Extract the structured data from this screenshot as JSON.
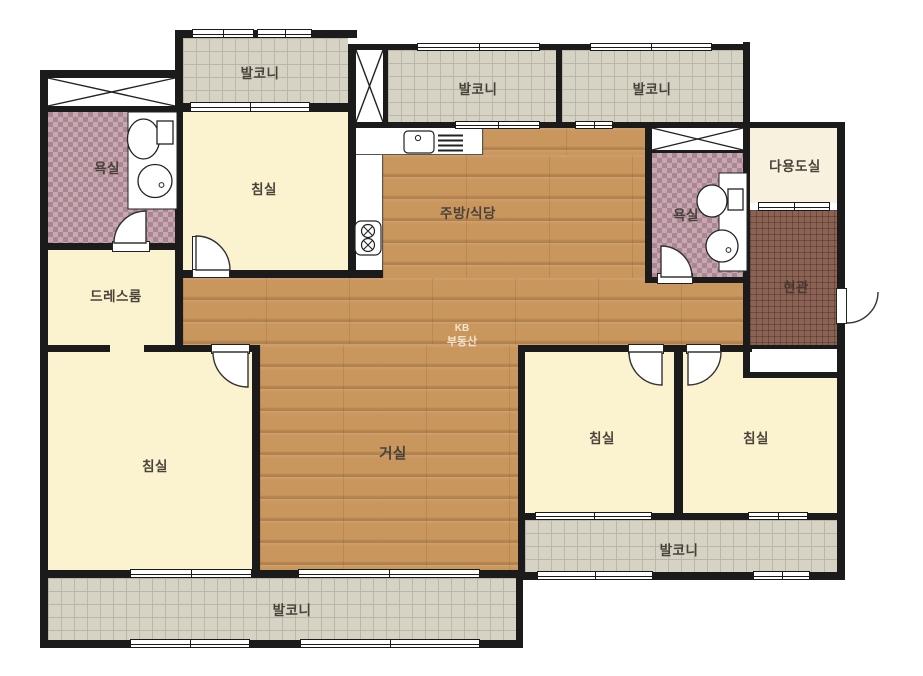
{
  "watermark": {
    "line1": "KB",
    "line2": "부동산"
  },
  "colors": {
    "wall": "#1b1b1b",
    "wood_floor": "#c9965e",
    "room_cream": "#fbf2cf",
    "balcony_tile": "#d6d3c4",
    "bathroom_tile": "#b28f9a",
    "entrance_tile": "#8b6355",
    "utility_fill": "#f8f1de"
  },
  "rooms": {
    "balcony_top_left": {
      "label": "발코니"
    },
    "balcony_top_mid": {
      "label": "발코니"
    },
    "balcony_top_right": {
      "label": "발코니"
    },
    "balcony_bottom_right": {
      "label": "발코니"
    },
    "balcony_bottom_left": {
      "label": "발코니"
    },
    "bathroom_left": {
      "label": "욕실"
    },
    "bathroom_right": {
      "label": "욕실"
    },
    "bedroom_top": {
      "label": "침실"
    },
    "bedroom_left": {
      "label": "침실"
    },
    "bedroom_mid": {
      "label": "침실"
    },
    "bedroom_right": {
      "label": "침실"
    },
    "dressroom": {
      "label": "드레스룸"
    },
    "kitchen": {
      "label": "주방/식당"
    },
    "living": {
      "label": "거실"
    },
    "utility": {
      "label": "다용도실"
    },
    "entrance": {
      "label": "현관"
    }
  }
}
